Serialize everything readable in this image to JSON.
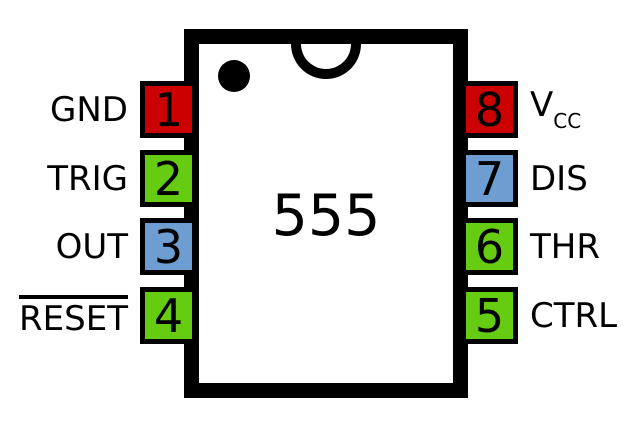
{
  "chip": {
    "label": "555"
  },
  "colors": {
    "red": "#CC0000",
    "green": "#66CC11",
    "blue": "#6D9DD1",
    "outline": "#000000",
    "background": "#FFFFFF"
  },
  "pins_left": [
    {
      "number": "1",
      "name": "GND",
      "color": "#CC0000",
      "overline": false
    },
    {
      "number": "2",
      "name": "TRIG",
      "color": "#66CC11",
      "overline": false
    },
    {
      "number": "3",
      "name": "OUT",
      "color": "#6D9DD1",
      "overline": false
    },
    {
      "number": "4",
      "name": "RESET",
      "color": "#66CC11",
      "overline": true
    }
  ],
  "pins_right": [
    {
      "number": "8",
      "name": "VCC",
      "label_main": "V",
      "label_sub": "CC",
      "color": "#CC0000"
    },
    {
      "number": "7",
      "name": "DIS",
      "color": "#6D9DD1"
    },
    {
      "number": "6",
      "name": "THR",
      "color": "#66CC11"
    },
    {
      "number": "5",
      "name": "CTRL",
      "color": "#66CC11"
    }
  ]
}
